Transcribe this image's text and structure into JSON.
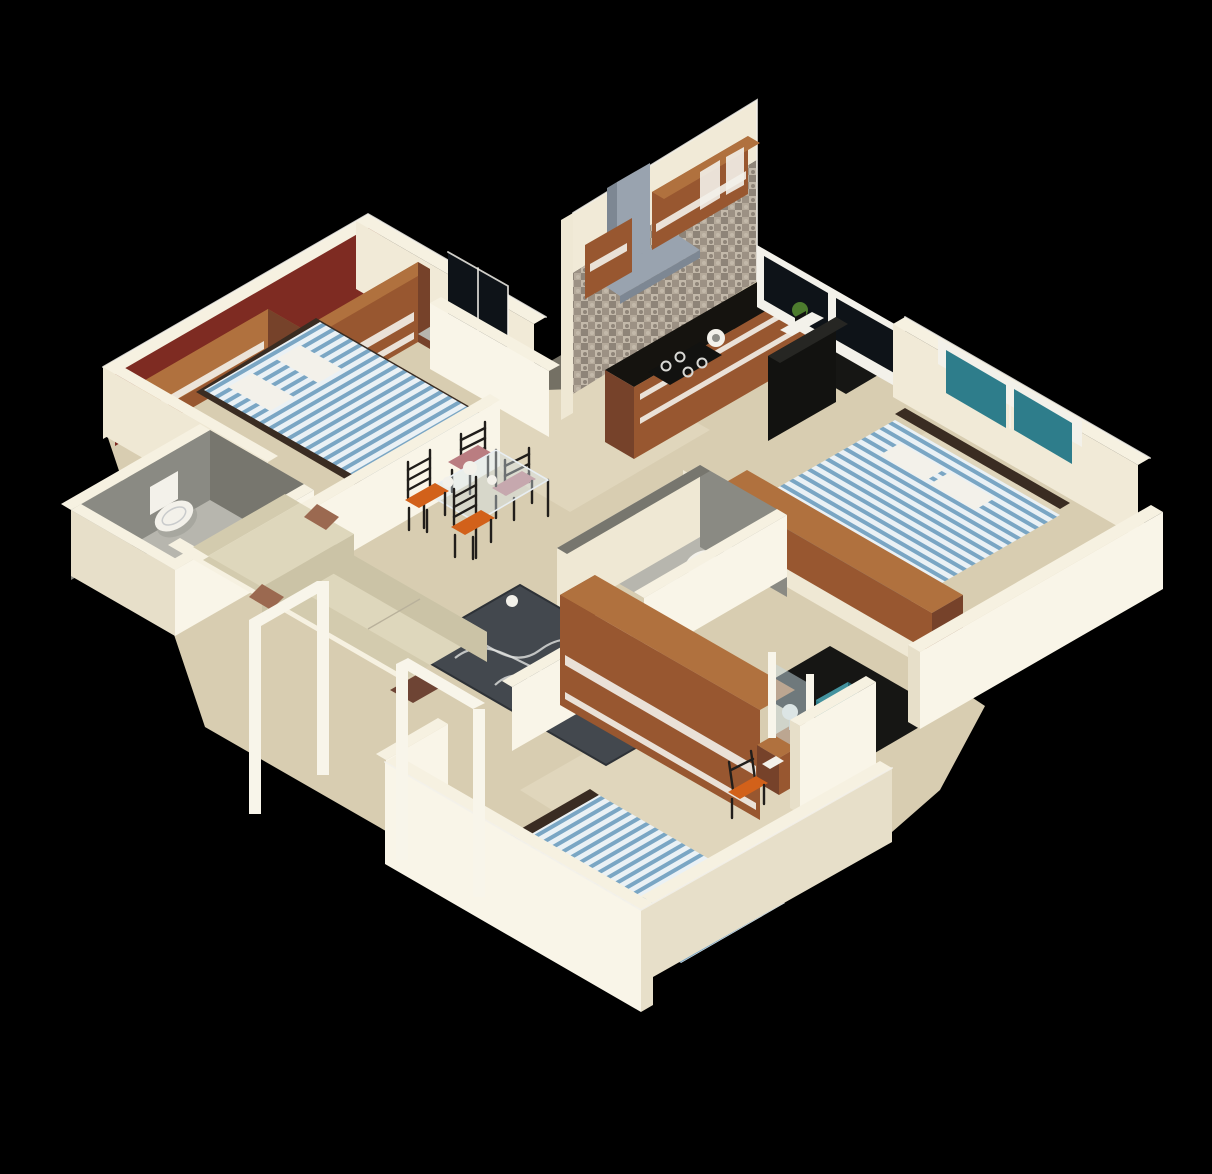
{
  "meta": {
    "kind": "3d-isometric-floor-plan-render",
    "canvas": {
      "width": 1212,
      "height": 1174
    },
    "background": "black"
  },
  "palette": {
    "bg": "#000000",
    "floor": "#d8cdb1",
    "floor-light": "#e8dfc7",
    "floor-grey": "#b7b6ae",
    "floor-dark": "#161614",
    "wall-top": "#f6f1e1",
    "wall-lit": "#efe8d4",
    "wall-lit2": "#e7dfc9",
    "wall-bright": "#f9f5e8",
    "wall-in": "#f1ead7",
    "maroon": "#7e2b22",
    "grey-in": "#8a8a83",
    "grey-in2": "#77766e",
    "wood-f": "#985730",
    "wood-t": "#b0713e",
    "wood-s": "#76422a",
    "counter": "#15130f",
    "black": "#121210",
    "stripe-bg": "#eaf1f5",
    "stripe-blue": "#7aa6c4",
    "bed-frame": "#3a2c22",
    "teal": "#2e7d8b",
    "teal-light": "#43929e",
    "teal-dark": "#256774",
    "window-glass": "#0e1318",
    "hood": "#99a3af",
    "hood-side": "#7d8793",
    "sofa-t": "#ded7bc",
    "sofa-f": "#cbc3a6",
    "sofa-b": "#d3cbae",
    "pillow": "#9b6950",
    "rug": "#43484e",
    "rug-line": "#e2e3e1",
    "orange": "#d2611a",
    "pink-seat": "#ba7d81",
    "chair-frame": "#211e1b",
    "white": "#f3f1ea",
    "lamp": "#f0eee6",
    "plant": "#4d7c2e",
    "door-frame": "#f8f5ea",
    "tile-a": "#b5aa9b",
    "tile-b": "#9c9184",
    "tile-c": "#c3b9aa",
    "tile-d": "#8e8478"
  },
  "scene": {
    "rooms": [
      {
        "id": "master-bedroom",
        "name": "Master Bedroom",
        "features": [
          "maroon accent wall",
          "double bed with blue-white striped cover",
          "two wooden wardrobes",
          "white pillows"
        ]
      },
      {
        "id": "shower-room",
        "name": "Attached Shower",
        "features": [
          "glass shower cubicle",
          "dark interior"
        ]
      },
      {
        "id": "toilet-room",
        "name": "Toilet / WC",
        "features": [
          "grey tiled walls",
          "white toilet"
        ]
      },
      {
        "id": "kitchen",
        "name": "Kitchen",
        "features": [
          "grey mosaic backsplash",
          "chimney hood",
          "brown wall cabinets",
          "black counter",
          "4-burner gas hob",
          "sink bowl"
        ]
      },
      {
        "id": "utility-balcony",
        "name": "Utility Balcony",
        "features": [
          "windows",
          "green plant",
          "white wash unit",
          "dark refrigerator"
        ]
      },
      {
        "id": "bedroom-2",
        "name": "Bedroom 2",
        "features": [
          "teal windows",
          "striped double bed",
          "long wooden wardrobe"
        ]
      },
      {
        "id": "common-bathroom",
        "name": "Common Bathroom",
        "features": [
          "grey tiled walls",
          "white toilet"
        ]
      },
      {
        "id": "living-dining",
        "name": "Living / Dining",
        "features": [
          "L-shaped cream sofa",
          "brown cushions",
          "grey rug with wavy lines",
          "glass dining table",
          "two orange chairs",
          "two pink chairs",
          "open white door frames",
          "dark ottoman"
        ]
      },
      {
        "id": "bedroom-3",
        "name": "Bedroom 3",
        "features": [
          "striped single bed with bolster",
          "sliding-door wardrobe",
          "bedside table with lamp",
          "orange chair"
        ]
      },
      {
        "id": "rear-balcony",
        "name": "Rear Balcony",
        "features": [
          "teal washing machine",
          "white parapet",
          "glass door"
        ]
      }
    ]
  }
}
